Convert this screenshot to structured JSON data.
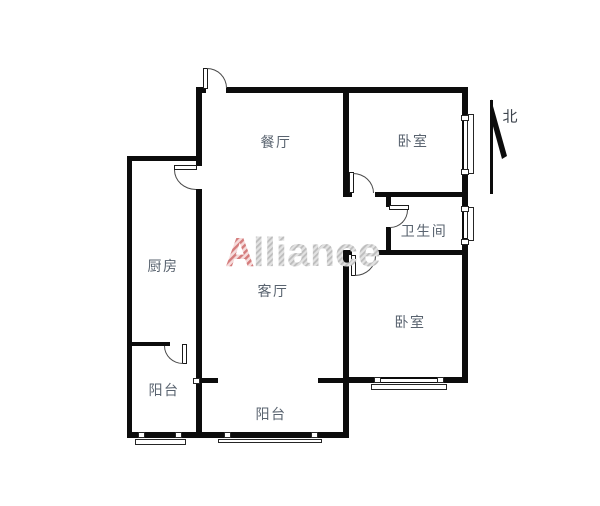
{
  "floorplan": {
    "rooms": [
      {
        "id": "dining-room",
        "label": "餐厅"
      },
      {
        "id": "bedroom-north",
        "label": "卧室"
      },
      {
        "id": "bathroom",
        "label": "卫生间"
      },
      {
        "id": "kitchen",
        "label": "厨房"
      },
      {
        "id": "living-room",
        "label": "客厅"
      },
      {
        "id": "bedroom-south",
        "label": "卧室"
      },
      {
        "id": "balcony-west",
        "label": "阳台"
      },
      {
        "id": "balcony-south",
        "label": "阳台"
      }
    ],
    "compass": {
      "label": "北"
    },
    "colors": {
      "wall": "#0c0c0c",
      "room_label": "#59636f",
      "watermark_accent": "#d47c7c",
      "watermark_gray": "#bdbdbd",
      "background": "#ffffff"
    }
  },
  "watermark": {
    "text": "Alliance",
    "accent_letter": "A",
    "rest": "lliance"
  }
}
